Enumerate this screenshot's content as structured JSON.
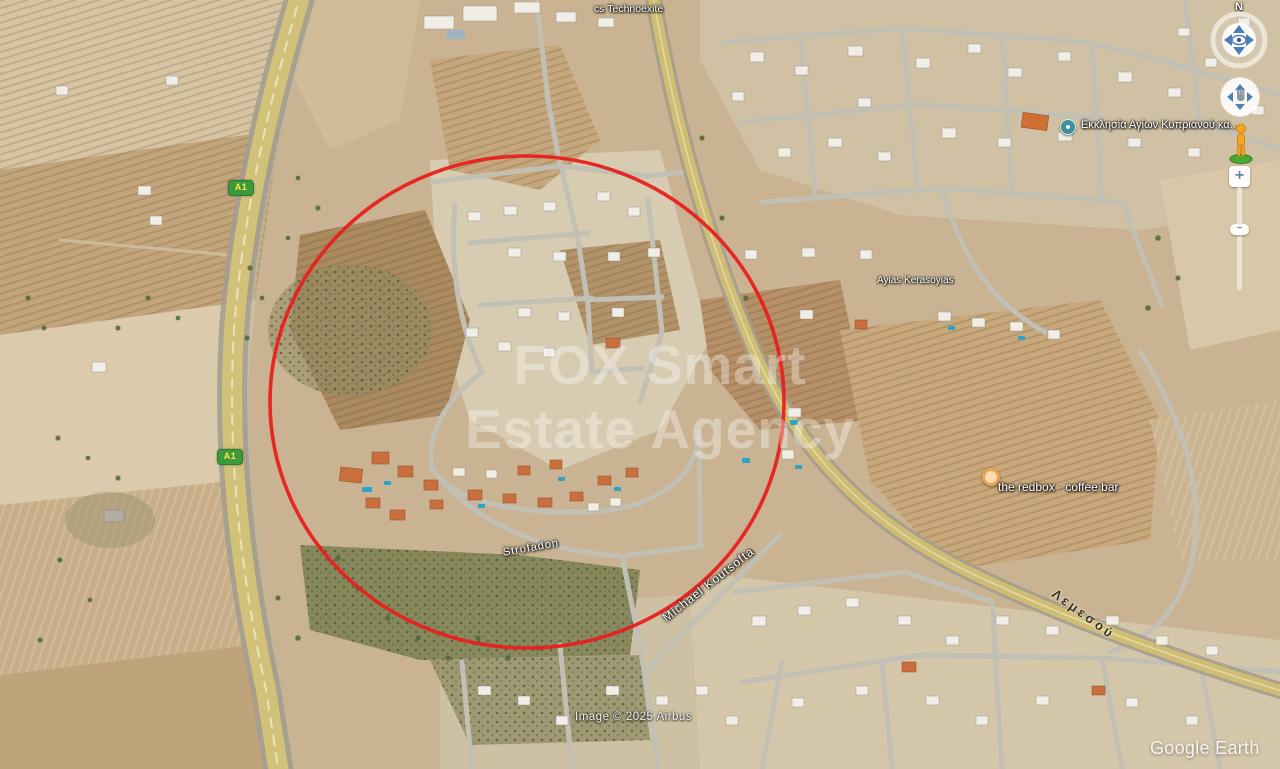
{
  "app": "Google Earth",
  "map": {
    "watermark_line1": "FOX Smart",
    "watermark_line2": "Estate Agency",
    "attribution": "Image © 2025 Airbus",
    "logo_text": "Google Earth"
  },
  "labels": {
    "business": "cs Technoexite",
    "church": "Εκκλησία Αγίων Κυπριανού κα...",
    "ayias": "Ayias Kerasoyias",
    "redbox": "the redbox · coffee bar",
    "strofadon": "Strofadon",
    "koutsofta": "Michael Koutsofta",
    "lemesou": "Λεμεσού",
    "a1": "A1"
  },
  "annotation": {
    "shape": "ellipse",
    "color": "#e8201e",
    "center_x": 527,
    "center_y": 402,
    "radius_x": 257,
    "radius_y": 246
  },
  "controls": {
    "north_label": "N",
    "zoom_in_label": "+",
    "zoom_out_label": "−",
    "icons": {
      "look": "eye-icon",
      "pan": "hand-icon",
      "street_view": "pegman-icon"
    }
  },
  "colors": {
    "annotation_red": "#e8201e",
    "a1_shield_green": "#3b9b3b",
    "a1_shield_text": "#ffe352",
    "highway_surface": "#d2c178",
    "terrain_base": "#c9b392"
  }
}
